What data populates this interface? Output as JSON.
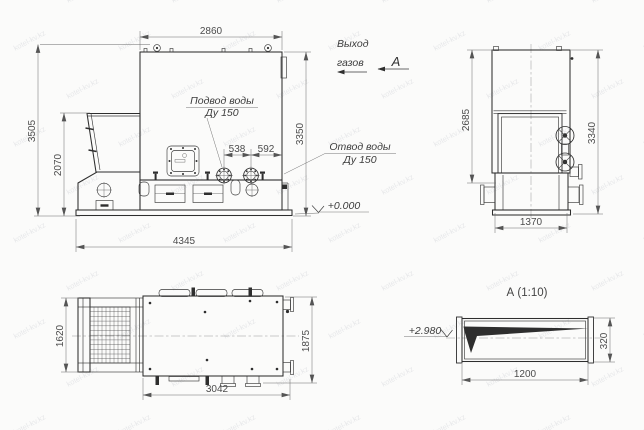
{
  "watermark": {
    "text": "kotel-kv.kz"
  },
  "side_view": {
    "dim_width_top": "2860",
    "dim_height_total": "3505",
    "dim_height_hopper": "2070",
    "dim_height_right": "3350",
    "dim_flange_1": "538",
    "dim_flange_2": "592",
    "dim_base_length": "4345",
    "label_water_inlet_1": "Подвод воды",
    "label_water_inlet_2": "Ду 150"
  },
  "annotations": {
    "gas_outlet_1": "Выход",
    "gas_outlet_2": "газов",
    "view_arrow_label": "А",
    "label_water_outlet_1": "Отвод воды",
    "label_water_outlet_2": "Ду 150",
    "level_zero": "+0.000"
  },
  "front_view": {
    "dim_height_body": "2685",
    "dim_height_total": "3340",
    "dim_base_width": "1370"
  },
  "top_view": {
    "dim_depth_left": "1620",
    "dim_depth_right": "1875",
    "dim_length": "3042"
  },
  "section_a": {
    "title": "А (1:10)",
    "dim_width": "1200",
    "dim_height": "320",
    "level_mark": "+2.980"
  }
}
